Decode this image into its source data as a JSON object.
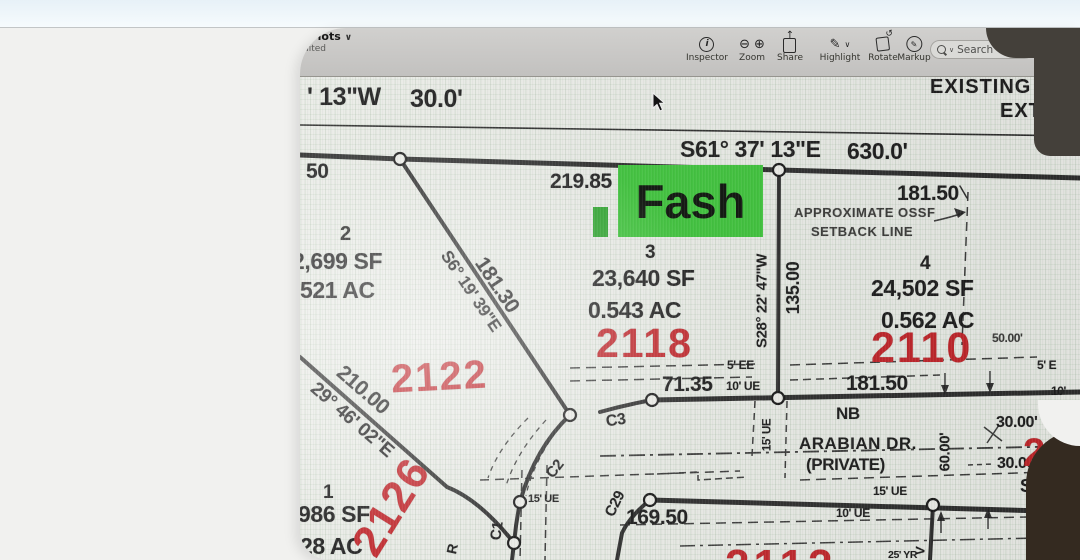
{
  "app": {
    "titlebar": {
      "title_partial": "h lots",
      "chevron": "∨",
      "edited_partial": "dited"
    },
    "toolbar": {
      "items": [
        {
          "label": "Inspector",
          "icon": "info-circle-icon"
        },
        {
          "label": "Zoom",
          "icon": "magnifier-minus-plus-icons",
          "glyph_minus": "⊖",
          "glyph_plus": "⊕"
        },
        {
          "label": "Share",
          "icon": "share-box-arrow-icon",
          "glyph": "↑"
        },
        {
          "label": "Highlight",
          "icon": "highlight-pen-icon",
          "glyph": "✎",
          "dropdown": "∨"
        },
        {
          "label": "Rotate",
          "icon": "rotate-page-icon",
          "glyph": "↺"
        },
        {
          "label": "Markup",
          "icon": "markup-pen-circle-icon",
          "glyph": "✎"
        }
      ],
      "search": {
        "placeholder": "Search",
        "chevron": "∨"
      }
    }
  },
  "colors": {
    "address_red": "#c0262b",
    "highlight_green": "#3fc33c",
    "paper": "#e9ebe6",
    "ink": "#1d1d1d",
    "page_bg": "#f1f1ef",
    "top_band": "#e7f1f7",
    "photo_dark_top": "#44403a",
    "photo_dark_bottom": "#342a20"
  },
  "plat": {
    "tl_bearing": "' 13\"W",
    "tl_dist": "30.0'",
    "existing1": "EXISTING",
    "existing2": "EXT",
    "n_bearing": "S61° 37' 13\"E",
    "n_dist": "630.0'",
    "d50": "50",
    "d21985": "219.85",
    "d18150_top": "181.50",
    "highlight": "Fash",
    "ossf1": "APPROXIMATE OSSF",
    "ossf2": "SETBACK LINE",
    "lot1": {
      "num": "1",
      "sf": "986 SF",
      "ac": "28 AC",
      "addr": "2126"
    },
    "lot2": {
      "num": "2",
      "sf": "2,699 SF",
      "ac": ".521 AC",
      "addr": "2122"
    },
    "lot3": {
      "num": "3",
      "sf": "23,640 SF",
      "ac": "0.543 AC",
      "addr": "2118"
    },
    "lot4": {
      "num": "4",
      "sf": "24,502 SF",
      "ac": "0.562 AC",
      "addr": "2110"
    },
    "b_s28": "S28° 22' 47\"W",
    "d135": "135.00",
    "d18130": "181.30",
    "b_s6": "S6° 19' 39\"E",
    "d21000": "210.00",
    "b_s29": "29° 46' 02\"E",
    "ee5": "5' EE",
    "d7135": "71.35",
    "ue10": "10' UE",
    "d18150_mid": "181.50",
    "e5": "5' E",
    "t10": "10'",
    "d5000": "50.00'",
    "c3": "C3",
    "c2": "C2",
    "c1": "C1",
    "c29": "C29",
    "nb": "NB",
    "street1": "ARABIAN DR.",
    "street2": "(PRIVATE)",
    "ue15_v": "15' UE",
    "d6000": "60.00'",
    "d3000a": "30.00'",
    "d3000b": "30.00'",
    "addr_partial": "2",
    "s_partial": "S",
    "ue15_b": "15' UE",
    "d16950": "169.50",
    "ue15_r": "15' UE",
    "ue10_b": "10' UE",
    "addr_2112": "2112",
    "yr25": "25' YR",
    "r_rot": "R",
    "v_rot": "V"
  }
}
